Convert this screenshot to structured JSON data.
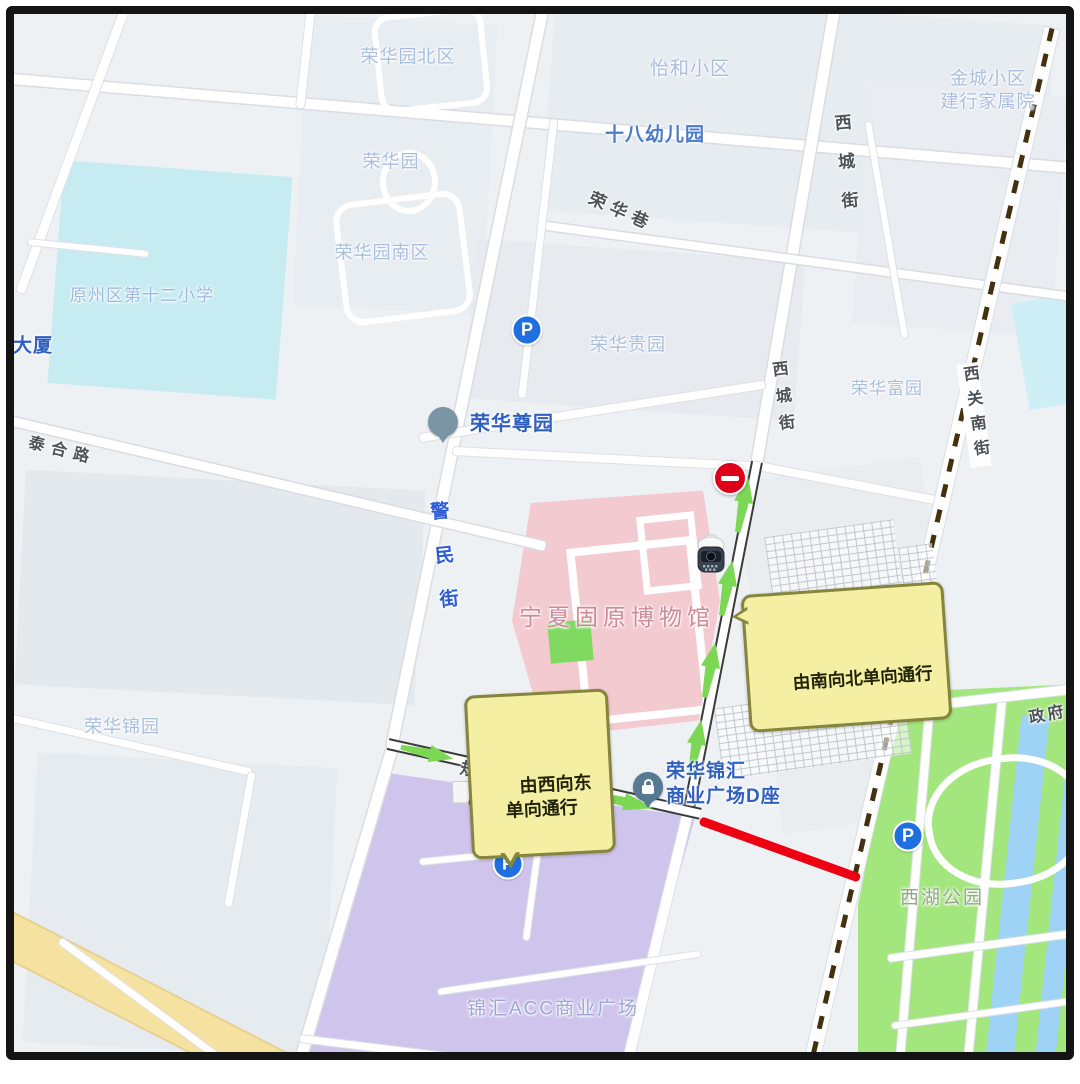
{
  "map_title": "固原博物馆周边单向通行示意图",
  "labels": [
    {
      "id": "ronghuayuan-north",
      "text": "荣华园北区"
    },
    {
      "id": "yihe-community",
      "text": "怡和小区"
    },
    {
      "id": "jincheng-community",
      "text": "金城小区\n建行家属院"
    },
    {
      "id": "no18-kindergarten",
      "text": "十八幼儿园"
    },
    {
      "id": "xicheng-street-north",
      "text": "西城街"
    },
    {
      "id": "ronghua-lane",
      "text": "荣华巷"
    },
    {
      "id": "ronghuayuan",
      "text": "荣华园"
    },
    {
      "id": "ronghuayuan-south",
      "text": "荣华园南区"
    },
    {
      "id": "no12-primary-school",
      "text": "原州区第十二小学"
    },
    {
      "id": "building-dasha",
      "text": "大厦"
    },
    {
      "id": "ronghua-guiyuan",
      "text": "荣华贵园"
    },
    {
      "id": "ronghua-fuyuan",
      "text": "荣华富园"
    },
    {
      "id": "xiguan-south-street",
      "text": "西关南街"
    },
    {
      "id": "ronghua-zunyuan",
      "text": "荣华尊园"
    },
    {
      "id": "taihe-road",
      "text": "泰合路"
    },
    {
      "id": "jingmin-street",
      "text": "警民街"
    },
    {
      "id": "museum",
      "text": "宁夏固原博物馆"
    },
    {
      "id": "museum-plaza",
      "text": "固原博物馆\n-博物馆广场"
    },
    {
      "id": "ronghua-jinyuan",
      "text": "荣华锦园"
    },
    {
      "id": "guihua-road-1",
      "text": "规划一路"
    },
    {
      "id": "ronghua-jinhui-plaza-d",
      "text": "荣华锦汇\n商业广场D座"
    },
    {
      "id": "zhengfu",
      "text": "政府"
    },
    {
      "id": "xihu-park",
      "text": "西湖公园"
    },
    {
      "id": "jinhui-acc-plaza",
      "text": "锦汇ACC商业广场"
    },
    {
      "id": "xicheng-street-mid",
      "text": "西城街"
    }
  ],
  "callouts": {
    "south_to_north": {
      "text": "由南向北单向通行"
    },
    "west_to_east": {
      "text": "由西向东\n单向通行"
    }
  },
  "badges": {
    "parking": "P"
  },
  "icons": {
    "no_entry_sign": "red-circle-white-bar",
    "dome_cctv_camera": "dome-camera-shape",
    "bullet_cctv_camera": "bullet-camera-shape",
    "house_pin_glyph": "⌂",
    "lock_pin_glyph": "lock-shape",
    "one_way_arrow": "green-arrow"
  },
  "colors": {
    "one_way_arrow": "#7cd854",
    "closed_road_segment": "#ee0013",
    "callout_bg": "#f4efa2",
    "callout_border": "#85853e",
    "railway_dash": "#42300f",
    "museum_area": "#f3cad0",
    "mall_area": "#cfc5ec",
    "park_area": "#a4e67e",
    "water": "#9fd3f6",
    "school_area": "#c6ecf2",
    "yellow_road": "#f6e2a0",
    "parking_badge": "#1f6fe0",
    "no_entry": "#de0018"
  }
}
